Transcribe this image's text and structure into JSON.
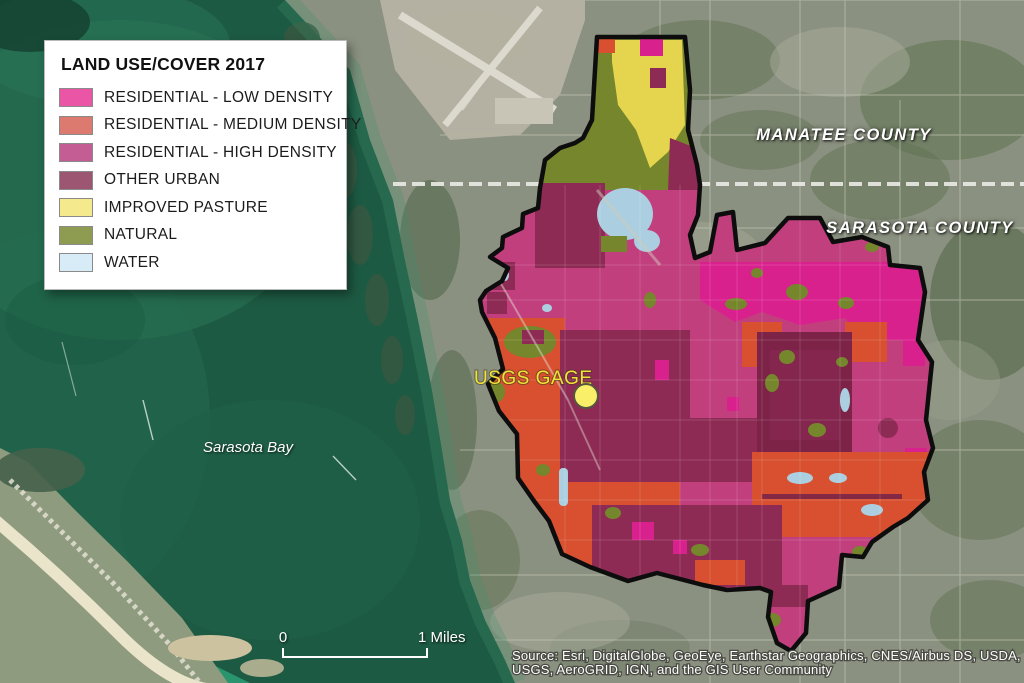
{
  "legend": {
    "title": "LAND USE/COVER 2017",
    "items": [
      {
        "label": "RESIDENTIAL - LOW DENSITY",
        "swatch": "#ea55a5"
      },
      {
        "label": "RESIDENTIAL - MEDIUM DENSITY",
        "swatch": "#dd7a70"
      },
      {
        "label": "RESIDENTIAL - HIGH DENSITY",
        "swatch": "#c45d94"
      },
      {
        "label": "OTHER URBAN",
        "swatch": "#9d5672"
      },
      {
        "label": "IMPROVED PASTURE",
        "swatch": "#f5e98e"
      },
      {
        "label": "NATURAL",
        "swatch": "#8e9c52"
      },
      {
        "label": "WATER",
        "swatch": "#d8ecf8"
      }
    ]
  },
  "labels": {
    "county_north": "MANATEE COUNTY",
    "county_south": "SARASOTA COUNTY",
    "bay": "Sarasota Bay",
    "gage": "USGS GAGE"
  },
  "scalebar": {
    "zero": "0",
    "end": "1 Miles"
  },
  "attribution": {
    "line1": "Source: Esri, DigitalGlobe, GeoEye, Earthstar Geographics, CNES/Airbus DS, USDA,",
    "line2": "USGS, AeroGRID, IGN, and the GIS User Community"
  },
  "colors": {
    "water_deep": "#1d5a43",
    "water_light": "#2e7b5c",
    "water_shallow": "#2ea27b",
    "land": "#8b9180",
    "airport_field": "#b7b3a3",
    "runway": "#dcdacf",
    "beach_sand": "#efe8d0",
    "island_veg": "#8f9b7e",
    "road": "#cbccbd",
    "county_line": "#e9e9e4",
    "boundary": "#0d0d0d",
    "gage_dot_fill": "#f9ef68",
    "gage_dot_stroke": "#55553f",
    "gage_text": "#f0e23c",
    "lu_low_map": "#d9218e",
    "lu_med_map": "#d8502f",
    "lu_high_map": "#c23f7e",
    "lu_other_map": "#8e2b55",
    "lu_other_dark": "#7c2347",
    "lu_pasture_map": "#e5d44e",
    "lu_natural_map": "#76862c",
    "lu_water_map": "#abcfe0"
  }
}
